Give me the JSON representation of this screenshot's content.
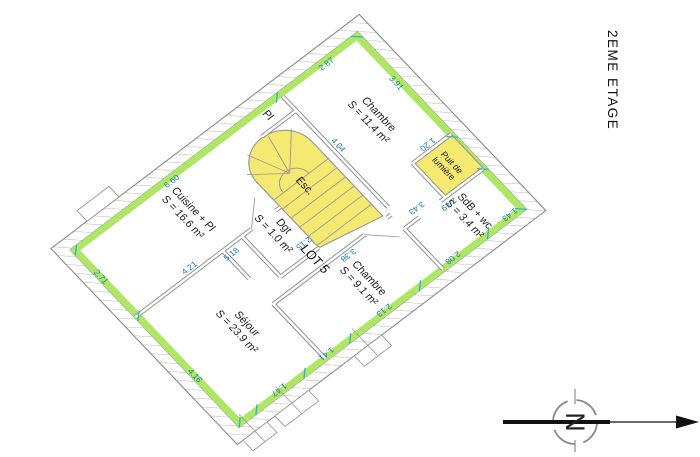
{
  "title": "2EME ETAGE",
  "compass": {
    "north_label": "N"
  },
  "lot_label": "LOT 5",
  "rooms": {
    "chambre1": {
      "name": "Chambre",
      "area": "S = 11.4 m²"
    },
    "chambre2": {
      "name": "Chambre",
      "area": "S = 9.1 m²"
    },
    "sdb": {
      "name": "SdB + wc",
      "area": "S = 3.4 m²"
    },
    "puit": {
      "line1": "Puit de",
      "line2": "lumière"
    },
    "cuisine": {
      "name": "Cuisine + Pl",
      "area": "S = 16.6 m²"
    },
    "sejour": {
      "name": "Séjour",
      "area": "S = 23.9 m²"
    },
    "dgt": {
      "name": "Dgt",
      "area": "S = 1.0 m²"
    },
    "esc": {
      "name": "Esc."
    },
    "pl": {
      "name": "Pl"
    }
  },
  "dimensions": {
    "top_391": "3.91",
    "left_287": "2.87",
    "left_660": "6.60",
    "right_143": "1.43",
    "right_208": "2.08",
    "right_213": "2.13",
    "right_141": "1.41",
    "right_147": "1.47",
    "bottom_271": "2.71",
    "bottom_416": "4.16",
    "int_404": "4.04",
    "int_120": "1.20",
    "int_249": "2.49",
    "int_343": "3.43",
    "int_338": "3.38",
    "int_215": "2.15",
    "int_518": "5.18",
    "int_421": "4.21"
  },
  "colors": {
    "wall_band_green": "#ade763",
    "stair_yellow": "#f6e972",
    "lightwell_yellow": "#f6e972",
    "dim_blue": "#1b78b4",
    "tick_teal": "#29b6cc"
  }
}
